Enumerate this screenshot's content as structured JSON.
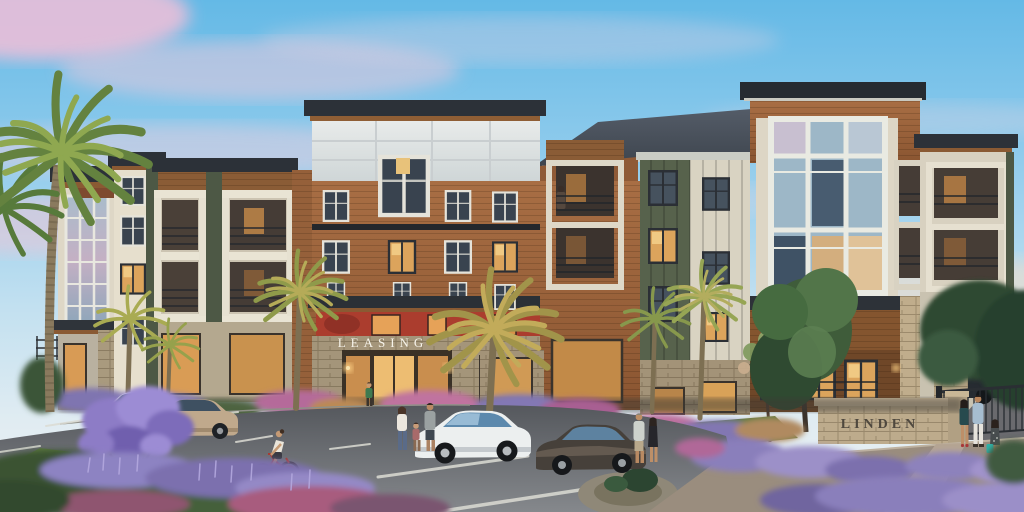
{
  "signs": {
    "leasing_label": "LEASING",
    "monument_label": "LINDEN"
  },
  "scene": {
    "subject": "four-story apartment building exterior at dusk",
    "sky": "dusk blue sky with pink clouds",
    "vehicles": [
      "white-suv",
      "tan-sedan",
      "white-sedan",
      "dark-brown-sedan",
      "dark-suv-background"
    ],
    "people": [
      "family-of-three",
      "cyclist-on-red-bike",
      "couple-by-brown-sedan",
      "couple-on-right-path",
      "woman-with-teal-bag",
      "man-by-dark-suv",
      "person-on-balcony",
      "person-at-entrance"
    ],
    "vegetation": [
      "tall-palm",
      "fan-palms",
      "entrance-palms",
      "purple-flowering-tree",
      "lavender-beds",
      "pink-shrubs",
      "green-street-trees",
      "lawn"
    ]
  },
  "palette": {
    "sky_top": "#64b9e6",
    "sky_horizon": "#eef2f2",
    "cloud_pink": "#f2c3d8",
    "roof_dark": "#2c3138",
    "shingle_roof": "#49515c",
    "wood_siding": "#a86e44",
    "cream_siding": "#e3dccb",
    "green_siding": "#57624c",
    "glass_blue": "#9db7c7",
    "accent_red": "#ab3d2e",
    "stone": "#b4a488",
    "warm_light": "#edbd72",
    "lavender": "#8d82c0",
    "pink_flowers": "#c0739f",
    "lawn_green": "#5c7a3e",
    "asphalt": "#5a5d62",
    "path": "#b5a593"
  }
}
